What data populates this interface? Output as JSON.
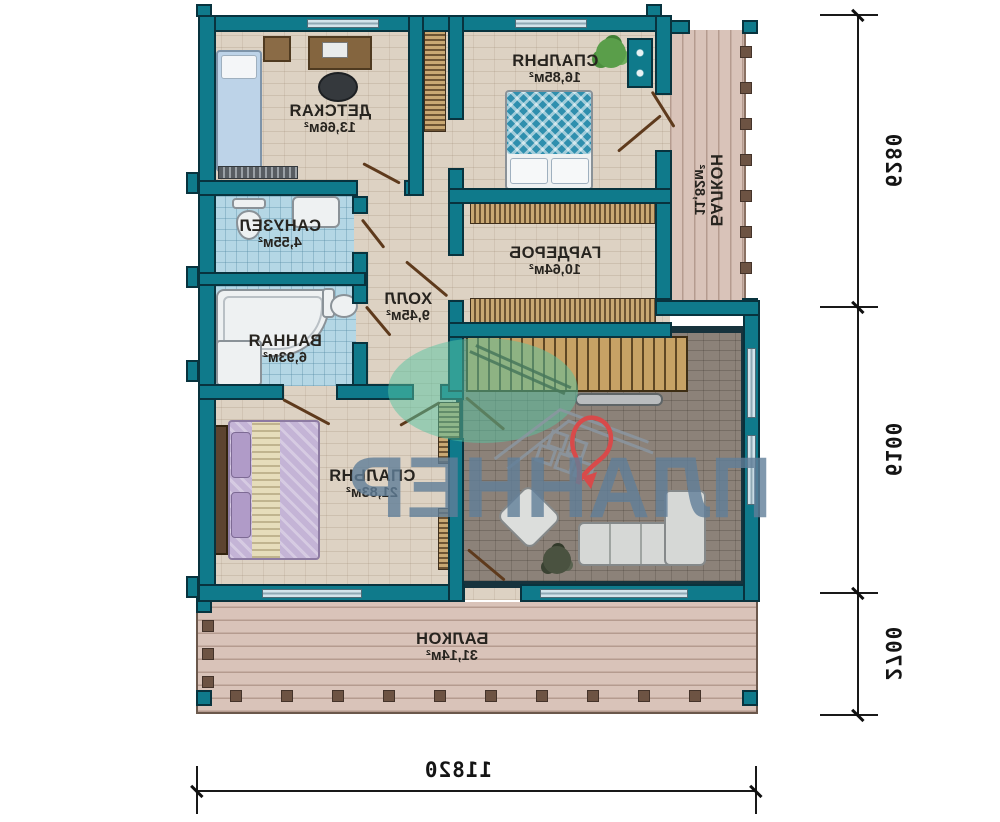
{
  "plan_title": "floor-plan-second-level",
  "rooms": {
    "detskaya": {
      "name": "ДЕТСКАЯ",
      "area": "13,66м²"
    },
    "spalnya1": {
      "name": "СПАЛЬНЯ",
      "area": "16,85м²"
    },
    "sanuzel": {
      "name": "САНУЗЕЛ",
      "area": "4,55м²"
    },
    "vannaya": {
      "name": "ВАННАЯ",
      "area": "6,93м²"
    },
    "holl": {
      "name": "ХОЛЛ",
      "area": "9,45м²"
    },
    "garderob": {
      "name": "ГАРДЕРОБ",
      "area": "10,64м²"
    },
    "spalnya2": {
      "name": "СПАЛЬНЯ",
      "area": "21,83м²"
    },
    "balkon1": {
      "name": "БАЛКОН",
      "area": "11,82м²"
    },
    "balkon2": {
      "name": "БАЛКОН",
      "area": "31,14м²"
    }
  },
  "dims": {
    "right": [
      "6280",
      "6100",
      "2700"
    ],
    "bottom": "11820"
  },
  "watermark": {
    "text": "ПЛАННЕР"
  },
  "colors": {
    "wall_teal": "#0f7a8b",
    "floor_beige": "#ddd2c3",
    "tile_blue": "#b4d7e5",
    "living_floor": "#8c8279",
    "balcony_floor": "#d9c3b9",
    "watermark_blue": "#607e99",
    "logo_green": "#56c4a2",
    "logo_red": "#d84a4a"
  },
  "note_text_mirrored": "all lettering on the plan is horizontally mirrored"
}
